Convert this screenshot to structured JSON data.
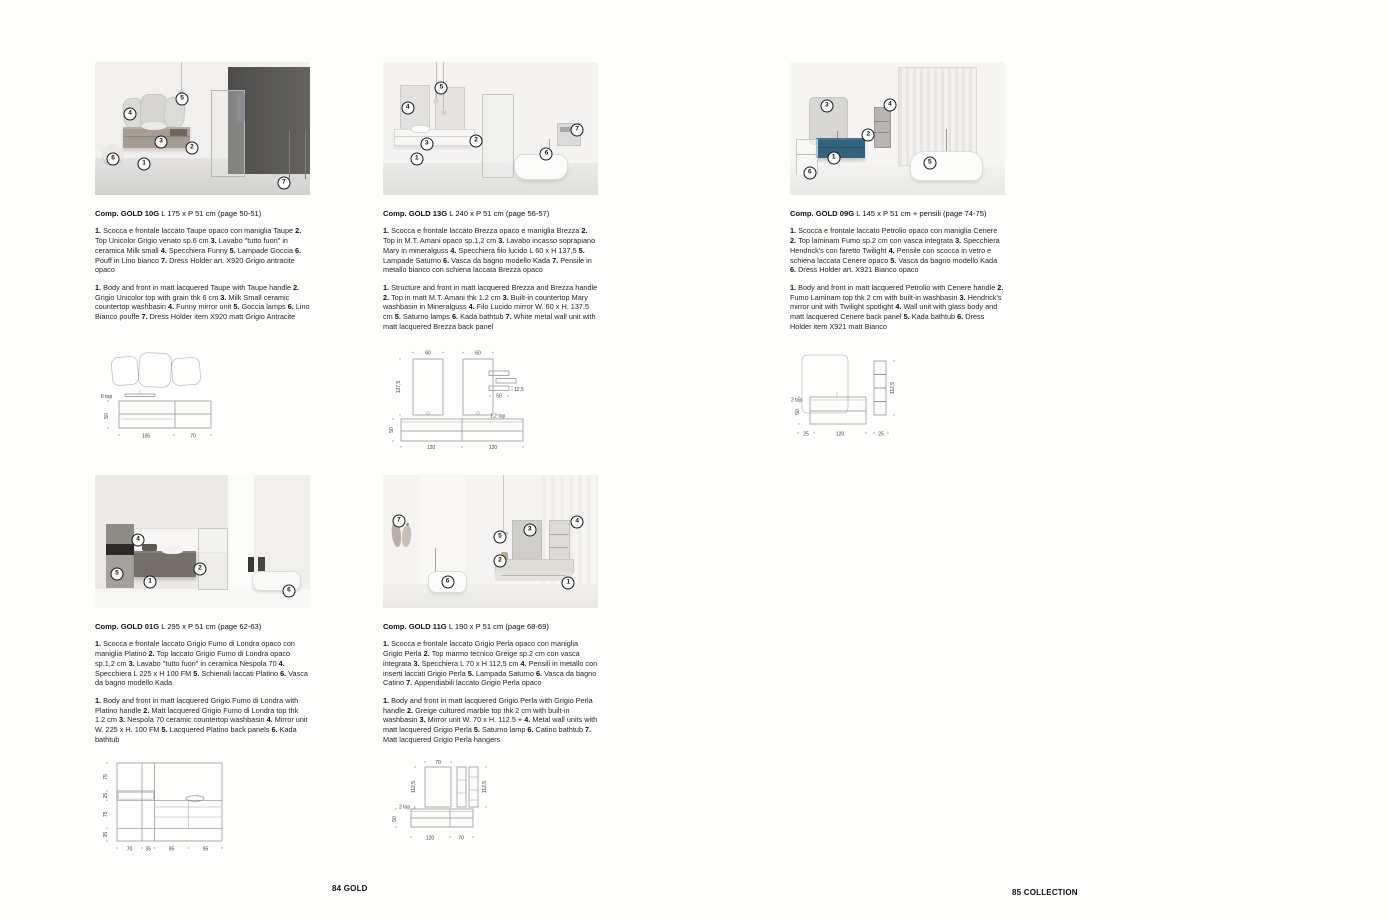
{
  "page": {
    "footer_left": "84 GOLD",
    "footer_right": "85 COLLECTION"
  },
  "colors": {
    "petrol_vanity": "#34617b",
    "taupe_vanity": "#a59d91",
    "dark_grey_wall": "#5f5e5c",
    "fumo_vanity": "#746f68",
    "callout_ring": "#161616"
  },
  "compositions": [
    {
      "code": "Comp. GOLD 10G",
      "size": "L 175 x P 51 cm (page 50-51)",
      "desc_it": [
        [
          "1.",
          "Scocca e frontale laccato Taupe opaco con maniglia Taupe"
        ],
        [
          "2.",
          "Top Unicolor Grigio venato sp.6 cm"
        ],
        [
          "3.",
          "Lavabo \"tutto fuori\" in ceramica Milk small"
        ],
        [
          "4.",
          "Specchiera Funny"
        ],
        [
          "5.",
          "Lampade Goccia"
        ],
        [
          "6.",
          "Pouff in Lino bianco"
        ],
        [
          "7.",
          "Dress Holder art. X920 Grigio antracite opaco"
        ]
      ],
      "desc_en": [
        [
          "1.",
          "Body and front in matt lacquered Taupe with Taupe handle"
        ],
        [
          "2.",
          "Grigio Unicolor top with grain thk 6 cm"
        ],
        [
          "3.",
          "Milk Small ceramic countertop washbasin"
        ],
        [
          "4.",
          "Funny mirror unit"
        ],
        [
          "5.",
          "Goccia lamps"
        ],
        [
          "6.",
          "Lino Bianco pouffe"
        ],
        [
          "7.",
          "Dress Holder item X920 matt Grigio Antracite"
        ]
      ],
      "callouts": [
        [
          1,
          22.8,
          76.7
        ],
        [
          2,
          45.1,
          64.7
        ],
        [
          3,
          30.7,
          60.2
        ],
        [
          4,
          16.3,
          39.1
        ],
        [
          5,
          40.5,
          27.8
        ],
        [
          6,
          8.4,
          72.9
        ],
        [
          7,
          87.9,
          91.0
        ]
      ],
      "drawing": {
        "top_label": "6 top",
        "h": "50",
        "w1": "105",
        "w2": "70"
      }
    },
    {
      "code": "Comp. GOLD 13G",
      "size": "L 240 x P 51 cm (page 56-57)",
      "desc_it": [
        [
          "1.",
          "Scocca e frontale laccato Brezza opaco e maniglia Brezza"
        ],
        [
          "2.",
          "Top in M.T. Amani opaco sp.1,2 cm"
        ],
        [
          "3.",
          "Lavabo incasso soprapiano Mary in mineralguss"
        ],
        [
          "4.",
          "Specchiera filo lucido L 60 x H 137,5"
        ],
        [
          "5.",
          "Lampade Saturno"
        ],
        [
          "6.",
          "Vasca da bagno modello Kada"
        ],
        [
          "7.",
          "Pensile in metallo bianco con schiena laccata Brezza opaco"
        ]
      ],
      "desc_en": [
        [
          "1.",
          "Structure and front in matt lacquered Brezza and Brezza handle"
        ],
        [
          "2.",
          "Top in matt M.T. Amani thk 1.2 cm"
        ],
        [
          "3.",
          "Built-in countertop Mary washbasin in Mineralguss"
        ],
        [
          "4.",
          "Filo Lucido mirror W. 60 x H. 137.5 cm"
        ],
        [
          "5.",
          "Saturno lamps"
        ],
        [
          "6.",
          "Kada bathtub"
        ],
        [
          "7.",
          "White metal wall unit with matt lacquered Brezza back panel"
        ]
      ],
      "callouts": [
        [
          1,
          15.7,
          72.9
        ],
        [
          2,
          43.3,
          59.4
        ],
        [
          3,
          20.3,
          61.7
        ],
        [
          4,
          11.5,
          34.6
        ],
        [
          5,
          27.2,
          19.5
        ],
        [
          6,
          76.0,
          69.2
        ],
        [
          7,
          90.3,
          51.1
        ]
      ],
      "drawing": {
        "w1": "60",
        "w2": "60",
        "h_mirror": "137,5",
        "h_cab": "50",
        "shelf_d": "12,5",
        "shelf_w": "50",
        "top_label": "1,2 top",
        "b1": "120",
        "b2": "120"
      }
    },
    {
      "code": "Comp. GOLD 09G",
      "size": "L 145 x P 51 cm + pensili (page 74-75)",
      "desc_it": [
        [
          "1.",
          "Scocca e frontale laccato Petrolio opaco con maniglia Cenere"
        ],
        [
          "2.",
          "Top laminam Fumo sp.2 cm con vasca integrata"
        ],
        [
          "3.",
          "Specchiera Hendrick's con faretto Twilight"
        ],
        [
          "4.",
          "Pensile con scocca in vetro e schiena laccata Cenere opaco"
        ],
        [
          "5.",
          "Vasca da bagno modello Kada"
        ],
        [
          "6.",
          "Dress Holder art. X921 Bianco opaco"
        ]
      ],
      "desc_en": [
        [
          "1.",
          "Body and front in matt lacquered Petrolio with Cenere handle"
        ],
        [
          "2.",
          "Fumo Laminam top thk 2 cm with built-in washbasin"
        ],
        [
          "3.",
          "Hendrick's mirror unit with Twilight spotlight"
        ],
        [
          "4.",
          "Wall unit with glass body and matt lacquered Cenere back panel"
        ],
        [
          "5.",
          "Kada bathtub"
        ],
        [
          "6.",
          "Dress Holder item X921 matt Bianco"
        ]
      ],
      "callouts": [
        [
          1,
          20.3,
          72.2
        ],
        [
          2,
          36.4,
          54.9
        ],
        [
          3,
          17.1,
          33.1
        ],
        [
          4,
          46.5,
          32.3
        ],
        [
          5,
          65.0,
          75.9
        ],
        [
          6,
          9.2,
          83.5
        ]
      ],
      "drawing": {
        "top_label": "2 top",
        "h": "50",
        "col_h": "112,5",
        "b1": "25",
        "b2": "120",
        "b3": "25"
      }
    },
    {
      "code": "Comp. GOLD 01G",
      "size": "L 295 x P 51 cm (page 62-63)",
      "desc_it": [
        [
          "1.",
          "Scocca e frontale laccato Grigio Fumo di Londra opaco con maniglia Platino"
        ],
        [
          "2.",
          "Top laccato Grigio Fumo di Londra opaco sp.1,2 cm"
        ],
        [
          "3.",
          "Lavabo \"tutto fuori\" in ceramica Nespola 70"
        ],
        [
          "4.",
          "Specchiera L 225 x H 100 FM"
        ],
        [
          "5.",
          "Schienali laccati Platino"
        ],
        [
          "6.",
          "Vasca da bagno modello Kada"
        ]
      ],
      "desc_en": [
        [
          "1.",
          "Body and front in matt lacquered Grigio Fumo di Londra with Platino handle"
        ],
        [
          "2.",
          "Matt lacquered Grigio Fumo di Londra top thk 1.2 cm"
        ],
        [
          "3.",
          "Nespola 70 ceramic countertop washbasin"
        ],
        [
          "4.",
          "Mirror unit W. 225 x H. 100 FM"
        ],
        [
          "5.",
          "Lacquered Platino back panels"
        ],
        [
          "6.",
          "Kada bathtub"
        ]
      ],
      "callouts": [
        [
          1,
          25.6,
          80.5
        ],
        [
          2,
          48.8,
          70.7
        ],
        [
          4,
          20.0,
          48.9
        ],
        [
          5,
          10.2,
          74.4
        ],
        [
          6,
          90.2,
          87.2
        ]
      ],
      "drawing": {
        "v1": "75",
        "v2": "25",
        "v3": "75",
        "v4": "35",
        "b1": "70",
        "b2": "35",
        "b3": "95",
        "b4": "95"
      }
    },
    {
      "code": "Comp. GOLD 11G",
      "size": "L 190 x P 51 cm (page 68-69)",
      "desc_it": [
        [
          "1.",
          "Scocca e frontale laccato Grigio Perla opaco con maniglia Grigio Perla"
        ],
        [
          "2.",
          "Top marmo tecnico Greige sp.2 cm con vasca integrata"
        ],
        [
          "3.",
          "Specchiera L 70 x H 112,5 cm"
        ],
        [
          "4.",
          "Pensili in metallo con inserti laccati Grigio Perla"
        ],
        [
          "5.",
          "Lampada Saturno"
        ],
        [
          "6.",
          "Vasca da bagno Catino"
        ],
        [
          "7.",
          "Appendiabili laccato Grigio Perla opaco"
        ]
      ],
      "desc_en": [
        [
          "1.",
          "Body and front in matt lacquered Grigio Perla with Grigio Perla handle"
        ],
        [
          "2.",
          "Greige cultured marble top thk 2 cm with built-in washbasin"
        ],
        [
          "3.",
          "Mirror unit W. 70 x H. 112.5 +"
        ],
        [
          "4.",
          "Metal wall units with matt lacquered Grigio Perla"
        ],
        [
          "5.",
          "Saturno lamp"
        ],
        [
          "6.",
          "Catino bathtub"
        ],
        [
          "7.",
          "Matt lacquered Grigio Perla hangers"
        ]
      ],
      "callouts": [
        [
          1,
          86.2,
          81.2
        ],
        [
          2,
          54.4,
          64.7
        ],
        [
          3,
          68.2,
          41.4
        ],
        [
          4,
          90.3,
          35.3
        ],
        [
          5,
          54.4,
          46.6
        ],
        [
          6,
          30.0,
          80.5
        ],
        [
          7,
          7.4,
          34.6
        ]
      ],
      "drawing": {
        "w": "70",
        "hl": "112,5",
        "hr": "112,5",
        "top_label": "2 top",
        "h": "50",
        "b1": "120",
        "b2": "70"
      }
    }
  ]
}
